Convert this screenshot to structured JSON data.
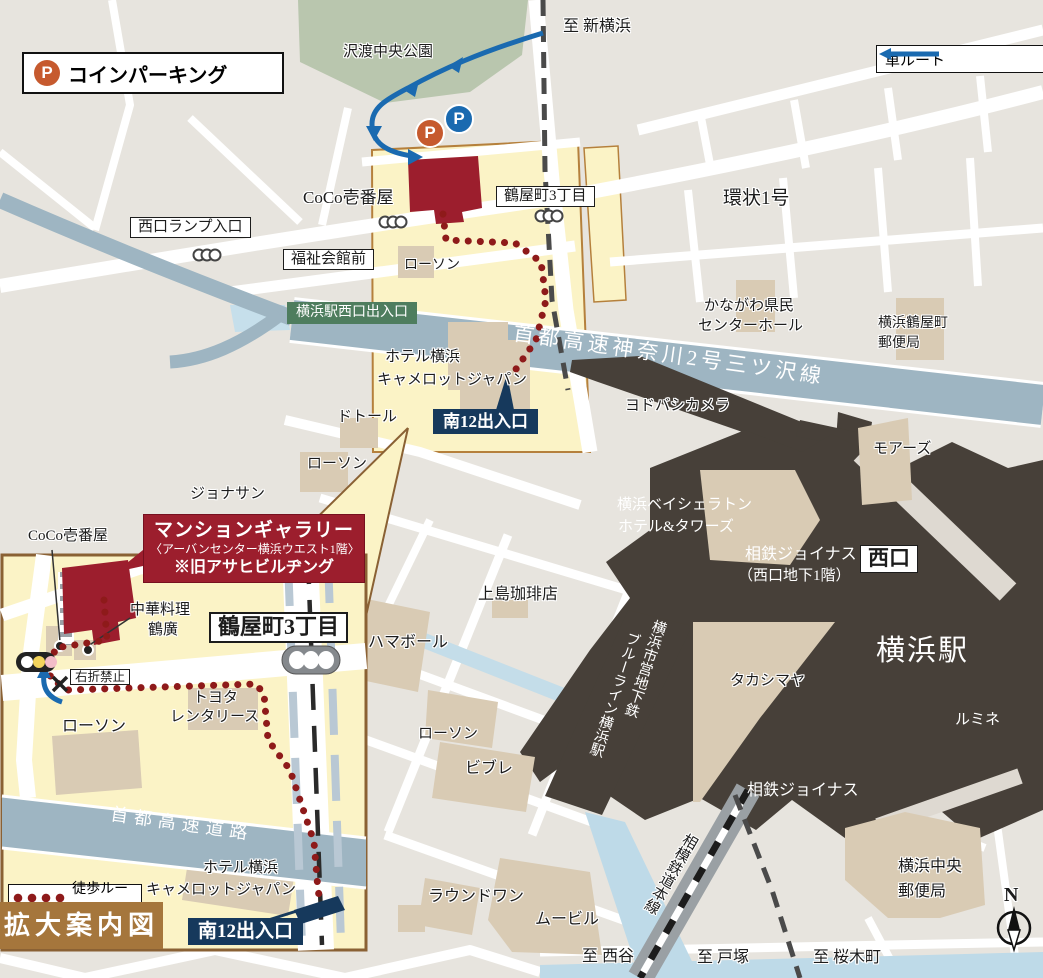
{
  "legend": {
    "coin_parking": "コインパーキング",
    "car_route": "車ルート",
    "walk_route": "徒歩ルート",
    "expand_title": "拡大案内図",
    "parking_mark": "P",
    "compass_north": "N"
  },
  "colors": {
    "highlight_yellow": "#fbf3c6",
    "highway_blue_gray": "#9eb5c2",
    "station_dark": "#474039",
    "gallery_red": "#9c1e2d",
    "walk_route_red": "#8e1a1a",
    "car_route_blue": "#1a6ab0",
    "exit_green": "#4e7d5e",
    "exit_navy": "#16395c",
    "parking_orange": "#c65a2e",
    "inset_border_brown": "#8a6134",
    "expand_box_brown": "#a5763c"
  },
  "main": {
    "to_shin_yokohama": "至 新横浜",
    "sawatari_park": "沢渡中央公園",
    "coco_ichibanya": "CoCo壱番屋",
    "tsuruyacho_3chome": "鶴屋町3丁目",
    "kanjo_1go": "環状1号",
    "nishiguchi_ramp": "西口ランプ入口",
    "fukushi_kaikan_mae": "福祉会館前",
    "lawson_north": "ローソン",
    "yokohama_west_exit": "横浜駅西口出入口",
    "shuto_kanagawa_line": "首都高速神奈川2号三ツ沢線",
    "kenmin_hall_1": "かながわ県民",
    "kenmin_hall_2": "センターホール",
    "tsuruyacho_post_1": "横浜鶴屋町",
    "tsuruyacho_post_2": "郵便局",
    "hotel_camelot_1": "ホテル横浜",
    "hotel_camelot_2": "キャメロットジャパン",
    "minami12_exit": "南12出入口",
    "yodobashi_camera": "ヨドバシカメラ",
    "moores": "モアーズ",
    "doutor": "ドトール",
    "lawson_mid": "ローソン",
    "jonathan": "ジョナサン",
    "sheraton_1": "横浜ベイシェラトン",
    "sheraton_2": "ホテル&タワーズ",
    "sotetsu_joinus_1": "相鉄ジョイナス",
    "sotetsu_joinus_2": "（西口地下1階）",
    "west_exit": "西口",
    "yokohama_station": "横浜駅",
    "ueshima_coffee": "上島珈琲店",
    "hama_bowl": "ハマボール",
    "takashimaya": "タカシマヤ",
    "lumine": "ルミネ",
    "subway_1": "横浜市営地下鉄",
    "subway_2": "ブルーライン横浜駅",
    "lawson_south": "ローソン",
    "vivre": "ビブレ",
    "sotetsu_joinus_south": "相鉄ジョイナス",
    "chuo_post_1": "横浜中央",
    "chuo_post_2": "郵便局",
    "round_one": "ラウンドワン",
    "movil": "ムービル",
    "to_nishiya": "至 西谷",
    "to_totsuka": "至 戸塚",
    "to_sakuragicho": "至 桜木町",
    "sotetsu_main_line": "相模鉄道本線"
  },
  "inset": {
    "coco_ichibanya": "CoCo壱番屋",
    "gallery_title": "マンションギャラリー",
    "gallery_sub": "〈アーバンセンター横浜ウエスト1階〉",
    "gallery_note": "※旧アサヒビルヂング",
    "chuka_1": "中華料理",
    "chuka_2": "鶴廣",
    "tsuruyacho_3chome": "鶴屋町3丁目",
    "no_right_turn": "右折禁止",
    "toyota_1": "トヨタ",
    "toyota_2": "レンタリース",
    "lawson": "ローソン",
    "shuto_expressway": "首都高速道路",
    "hotel_camelot_1": "ホテル横浜",
    "hotel_camelot_2": "キャメロットジャパン",
    "minami12_exit": "南12出入口"
  }
}
